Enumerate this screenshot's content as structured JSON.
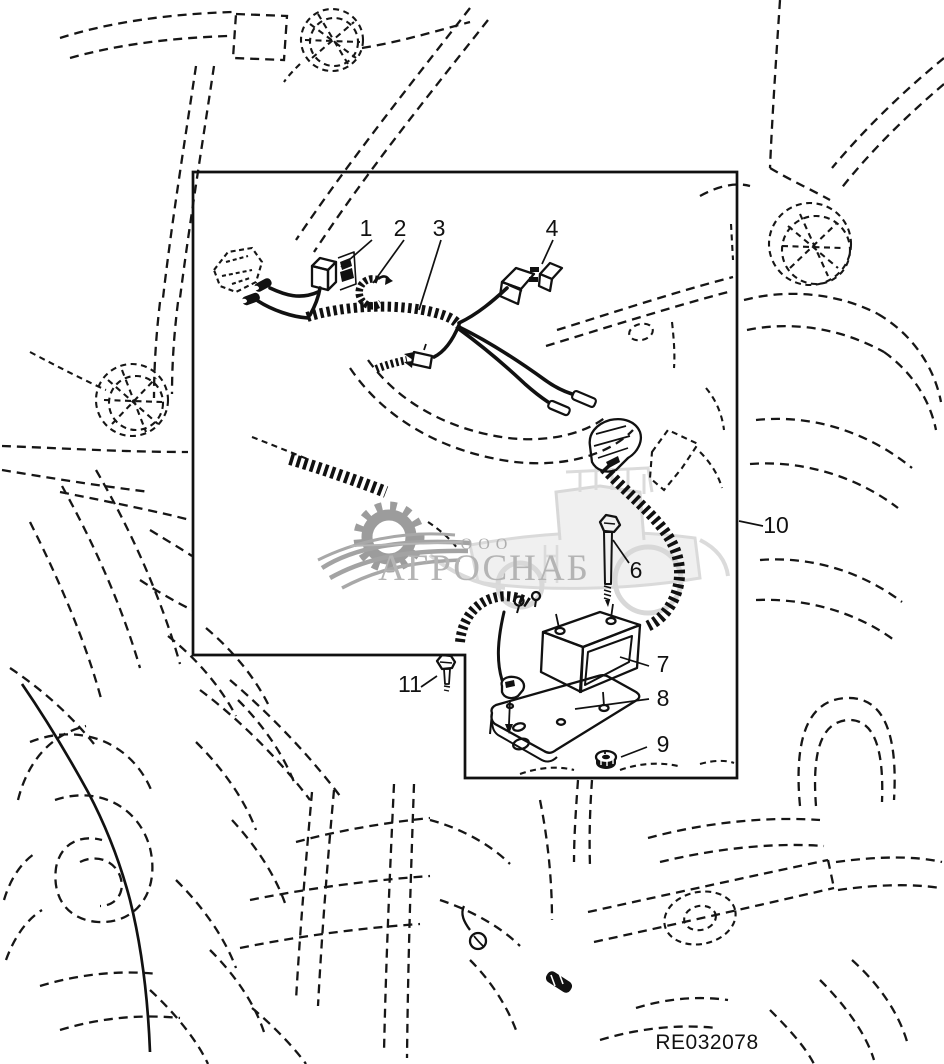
{
  "figure": {
    "type": "tractor-wiring-harness-parts-diagram",
    "part_number": "RE032078",
    "watermark": {
      "org_prefix": "ООО",
      "org_name": "АГРОСНАБ",
      "accent_gray": "#b4b4b4"
    },
    "callouts": [
      {
        "label": "1"
      },
      {
        "label": "2"
      },
      {
        "label": "3"
      },
      {
        "label": "4"
      },
      {
        "label": "6"
      },
      {
        "label": "7"
      },
      {
        "label": "8"
      },
      {
        "label": "9"
      },
      {
        "label": "10"
      },
      {
        "label": "11"
      }
    ]
  }
}
